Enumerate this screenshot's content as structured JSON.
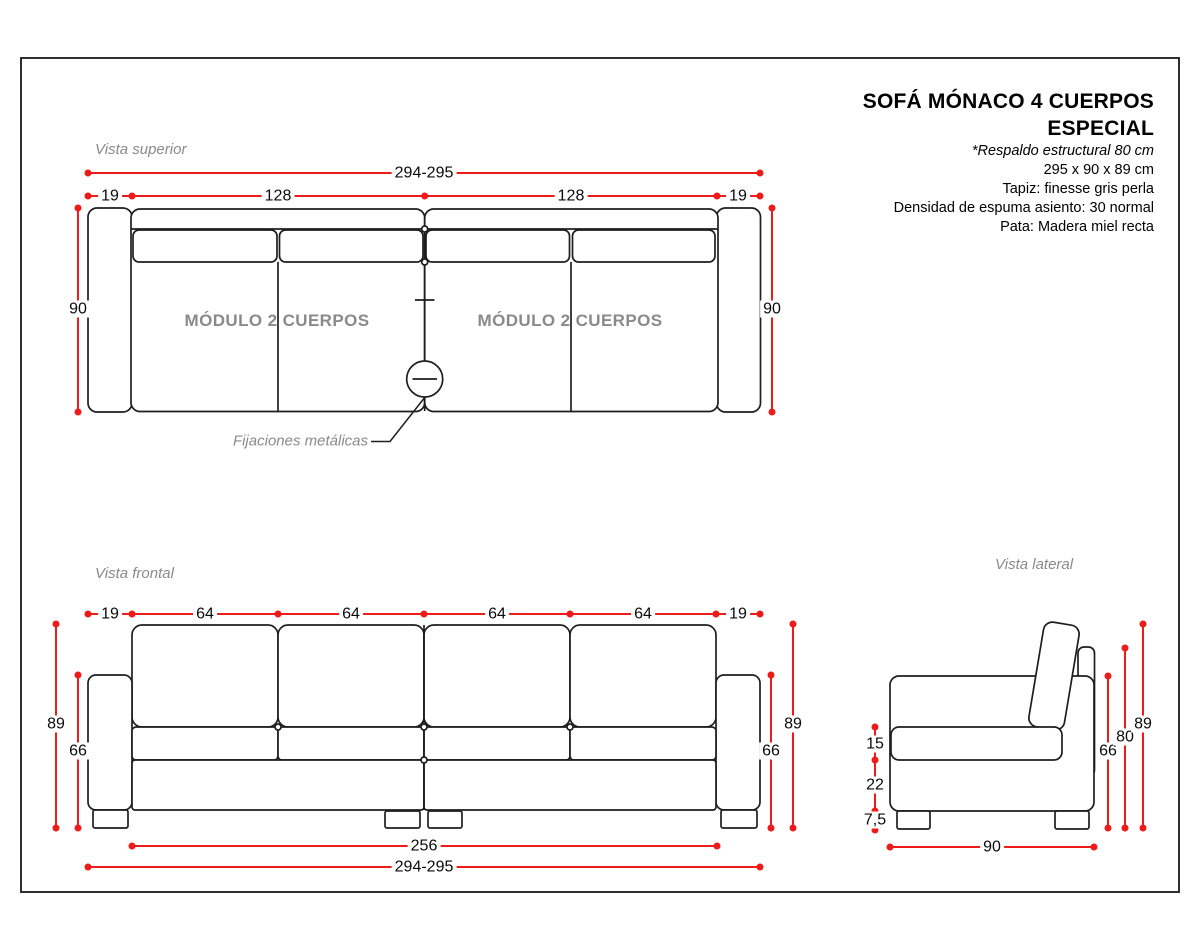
{
  "title_block": {
    "title_line1": "SOFÁ MÓNACO 4 CUERPOS",
    "title_line2": "ESPECIAL",
    "note": "*Respaldo estructural 80 cm",
    "size": "295 x 90 x 89 cm",
    "upholstery": "Tapiz: finesse gris perla",
    "foam": "Densidad de espuma asiento: 30 normal",
    "leg": "Pata: Madera miel recta"
  },
  "top_view": {
    "label": "Vista superior",
    "dim_overall": "294-295",
    "dim_segments": [
      "19",
      "128",
      "128",
      "19"
    ],
    "dim_depth_left": "90",
    "dim_depth_right": "90",
    "module_left_label": "MÓDULO 2 CUERPOS",
    "module_right_label": "MÓDULO 2 CUERPOS",
    "fixings_label": "Fijaciones metálicas"
  },
  "front_view": {
    "label": "Vista frontal",
    "dim_segments": [
      "19",
      "64",
      "64",
      "64",
      "64",
      "19"
    ],
    "dim_height_left": "89",
    "dim_arm_height_left": "66",
    "dim_arm_height_right": "66",
    "dim_height_right": "89",
    "dim_inner_width": "256",
    "dim_overall": "294-295"
  },
  "side_view": {
    "label": "Vista lateral",
    "dim_seat_thickness": "15",
    "dim_base_height": "22",
    "dim_leg_height": "7,5",
    "dim_arm_height": "66",
    "dim_back_height": "80",
    "dim_total_height": "89",
    "dim_depth": "90"
  },
  "colors": {
    "dimension_red": "#ee1b1b",
    "drawing_line": "#1e1e1e",
    "muted_gray": "#8a8a8a"
  }
}
